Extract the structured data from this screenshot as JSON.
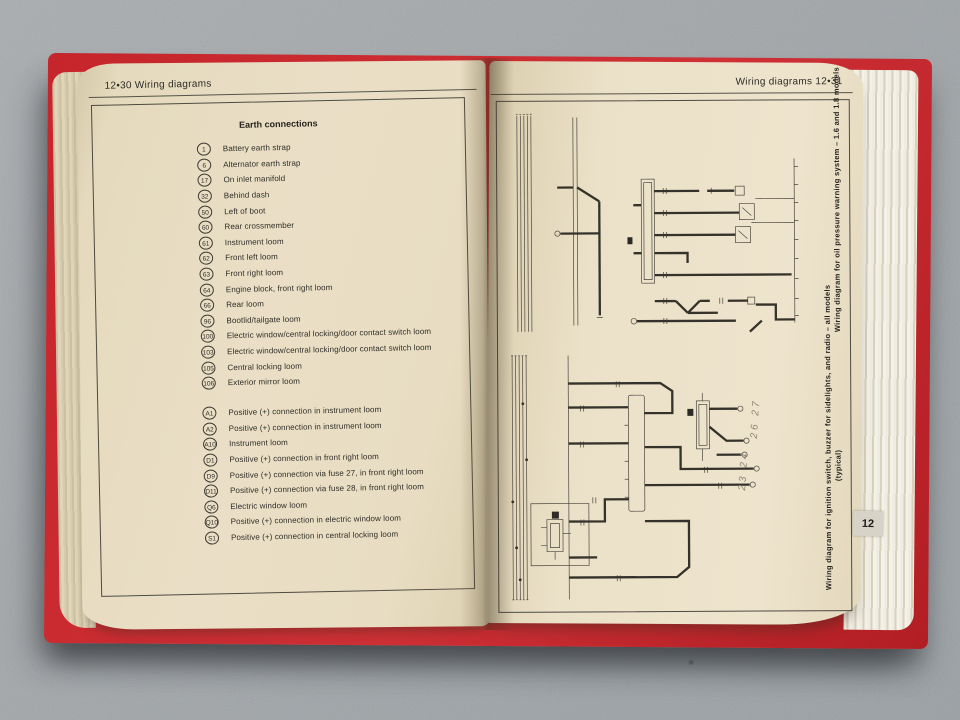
{
  "book": {
    "left_page": {
      "header": "12•30  Wiring diagrams",
      "box_title": "Earth connections",
      "earth_connections": [
        {
          "id": "1",
          "label": "Battery earth strap"
        },
        {
          "id": "6",
          "label": "Alternator earth strap"
        },
        {
          "id": "17",
          "label": "On inlet manifold"
        },
        {
          "id": "32",
          "label": "Behind dash"
        },
        {
          "id": "50",
          "label": "Left of boot"
        },
        {
          "id": "60",
          "label": "Rear crossmember"
        },
        {
          "id": "61",
          "label": "Instrument loom"
        },
        {
          "id": "62",
          "label": "Front left loom"
        },
        {
          "id": "63",
          "label": "Front right loom"
        },
        {
          "id": "64",
          "label": "Engine block, front right loom"
        },
        {
          "id": "66",
          "label": "Rear loom"
        },
        {
          "id": "96",
          "label": "Bootlid/tailgate loom"
        },
        {
          "id": "100",
          "label": "Electric window/central locking/door contact switch loom"
        },
        {
          "id": "103",
          "label": "Electric window/central locking/door contact switch loom"
        },
        {
          "id": "105",
          "label": "Central locking loom"
        },
        {
          "id": "106",
          "label": "Exterior mirror loom"
        }
      ],
      "positive_connections": [
        {
          "id": "A1",
          "label": "Positive (+) connection in instrument loom"
        },
        {
          "id": "A2",
          "label": "Positive (+) connection in instrument loom"
        },
        {
          "id": "A10",
          "label": "Instrument loom"
        },
        {
          "id": "D1",
          "label": "Positive (+) connection in front right loom"
        },
        {
          "id": "D9",
          "label": "Positive (+) connection via fuse 27, in front right loom"
        },
        {
          "id": "D11",
          "label": "Positive (+) connection via fuse 28, in front right loom"
        },
        {
          "id": "Q6",
          "label": "Electric window loom"
        },
        {
          "id": "Q10",
          "label": "Positive (+) connection in electric window loom"
        },
        {
          "id": "S1",
          "label": "Positive (+) connection in central locking loom"
        }
      ]
    },
    "right_page": {
      "header": "Wiring diagrams  12•31",
      "captions": {
        "top": "Wiring diagram for oil pressure warning system – 1.6 and 1.8 models",
        "bottom": "Wiring diagram for ignition switch, buzzer for sidelights, and radio – all models",
        "bottom_note": "(typical)"
      },
      "handwritten": {
        "upper": "26 27",
        "lower": "23 24"
      },
      "tab_label": "12"
    },
    "colors": {
      "cover_red": "#c5262c",
      "page_cream": "#eadfc6",
      "ink": "#2f2c27",
      "pencil": "#8b8679",
      "surface_gray": "#a6aaad"
    }
  }
}
